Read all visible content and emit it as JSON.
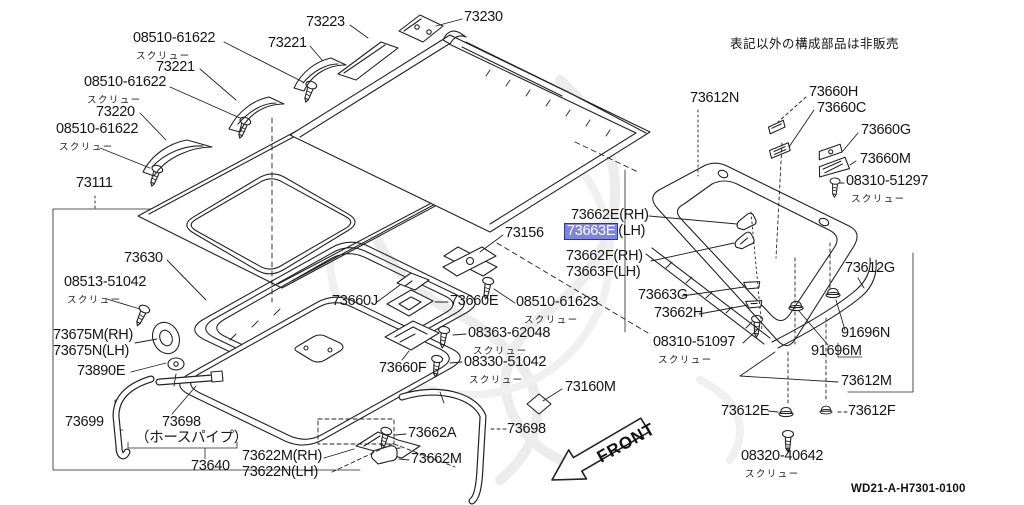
{
  "note_top_right": "表記以外の構成部品は非販売",
  "diagram_code": "WD21-A-H7301-0100",
  "front_arrow_label": "FRONT",
  "captions": {
    "screw": "スクリュー",
    "hose_pipe": "（ホースパイプ）"
  },
  "highlight": {
    "bg": "#7e85d8",
    "border": "#2d31a6",
    "text_color": "#ffffff"
  },
  "labels": {
    "p08510_61622": "08510-61622",
    "p73221": "73221",
    "p73223": "73223",
    "p73230": "73230",
    "p73220": "73220",
    "p73111": "73111",
    "p73630": "73630",
    "p08513_51042": "08513-51042",
    "p73675M": "73675M(RH)",
    "p73675N": "73675N(LH)",
    "p73890E": "73890E",
    "p73699": "73699",
    "p73698": "73698",
    "p73640": "73640",
    "p73622M": "73622M(RH)",
    "p73622N": "73622N(LH)",
    "p73662A": "73662A",
    "p73662M": "73662M",
    "p73160M": "73160M",
    "p73156": "73156",
    "p73660J": "73660J",
    "p73660E": "73660E",
    "p08510_61623": "08510-61623",
    "p08363_62048": "08363-62048",
    "p08330_51042": "08330-51042",
    "p73660F": "73660F",
    "p73662E": "73662E(RH)",
    "p73663E": "73663E",
    "p73663E_sfx": "(LH)",
    "p73662F": "73662F(RH)",
    "p73663F": "73663F(LH)",
    "p73663G": "73663G",
    "p73662H": "73662H",
    "p08310_51097": "08310-51097",
    "p73612N": "73612N",
    "p73660H": "73660H",
    "p73660C": "73660C",
    "p73660G": "73660G",
    "p73660M": "73660M",
    "p08310_51297": "08310-51297",
    "p73612G": "73612G",
    "p91696N": "91696N",
    "p91696M": "91696M",
    "p73612M": "73612M",
    "p73612E": "73612E",
    "p73612F": "73612F",
    "p08320_40642": "08320-40642"
  }
}
